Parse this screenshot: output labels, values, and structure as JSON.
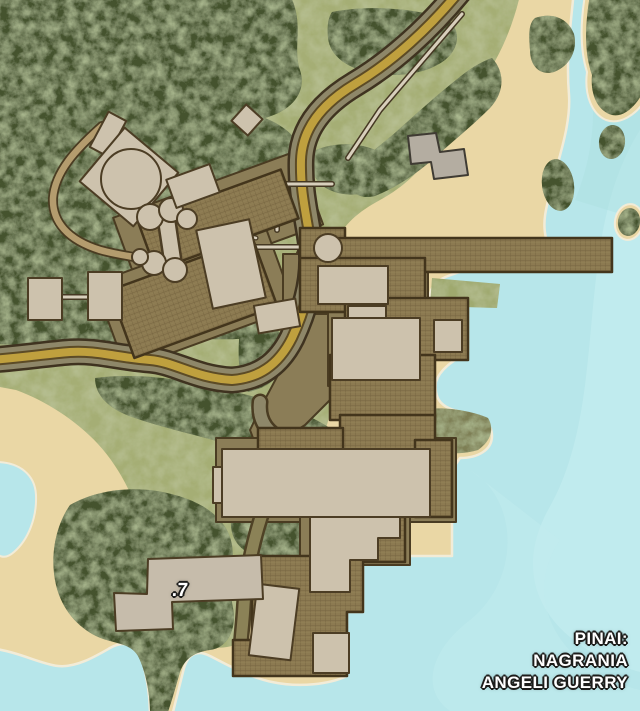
{
  "caption": {
    "line1": "PINAI:",
    "line2": "NAGRANIA",
    "line3": "ANGELI GUERRY"
  },
  "markers": {
    "m7": {
      "label": ".7"
    }
  },
  "features": {
    "terrain": [
      "water",
      "beach-sand",
      "grassland",
      "forest",
      "rocky-headland",
      "cove",
      "island"
    ],
    "structures": [
      "industrial-complex",
      "storage-tanks",
      "pier",
      "large-building",
      "dock-platform",
      "marked-building-7",
      "beach-building"
    ],
    "routes": [
      "main-road",
      "dirt-road",
      "footpaths"
    ]
  },
  "palette": {
    "water": "#b7e6ea",
    "wave": "#c9eef1",
    "sand": "#ead7a5",
    "shoreline": "#f2ecd8",
    "grass": "#a5ae74",
    "forest": "#44522e",
    "rock": "#7e7f55",
    "road_fill": "#8e8769",
    "road_stripe": "#bfa03e",
    "tan_path": "#b49c6e",
    "apron": "#8b7d57",
    "platform_hatch": "#8c7a51",
    "building": "#cdc2ad",
    "building_gray": "#b4ada1",
    "outline": "#4a3c22",
    "label_text": "#ffffff",
    "label_outline": "#1d1d1b"
  }
}
